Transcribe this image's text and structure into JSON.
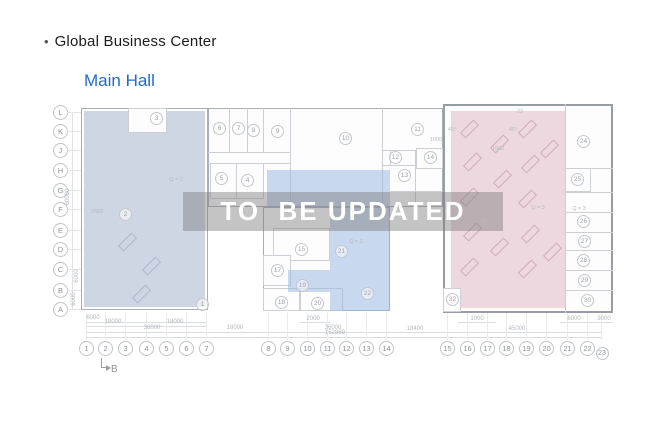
{
  "header": {
    "bullet": "•",
    "title": "Global Business Center",
    "subtitle": "Main Hall"
  },
  "watermark": {
    "text": "TO  BE UPDATED"
  },
  "colors": {
    "subtitle_accent": "#1c6dc9",
    "zone_left": "rgba(167,183,205,0.55)",
    "zone_middle": "rgba(148,180,226,0.5)",
    "zone_right": "rgba(214,164,182,0.42)",
    "watermark_bg": "rgba(125,125,125,0.45)",
    "watermark_text": "#ffffff"
  },
  "plan": {
    "row_axes": [
      {
        "label": "L",
        "y": 112
      },
      {
        "label": "K",
        "y": 131
      },
      {
        "label": "J",
        "y": 150
      },
      {
        "label": "H",
        "y": 170
      },
      {
        "label": "G",
        "y": 190
      },
      {
        "label": "F",
        "y": 209
      },
      {
        "label": "E",
        "y": 230
      },
      {
        "label": "D",
        "y": 249
      },
      {
        "label": "C",
        "y": 269
      },
      {
        "label": "B",
        "y": 290
      },
      {
        "label": "A",
        "y": 309
      }
    ],
    "col_axes": [
      {
        "label": "1",
        "x": 86
      },
      {
        "label": "2",
        "x": 105
      },
      {
        "label": "3",
        "x": 125
      },
      {
        "label": "4",
        "x": 146
      },
      {
        "label": "5",
        "x": 166
      },
      {
        "label": "6",
        "x": 186
      },
      {
        "label": "7",
        "x": 206
      },
      {
        "label": "8",
        "x": 268
      },
      {
        "label": "9",
        "x": 287
      },
      {
        "label": "10",
        "x": 307
      },
      {
        "label": "11",
        "x": 327
      },
      {
        "label": "12",
        "x": 346
      },
      {
        "label": "13",
        "x": 366
      },
      {
        "label": "14",
        "x": 386
      },
      {
        "label": "15",
        "x": 447
      },
      {
        "label": "16",
        "x": 467
      },
      {
        "label": "17",
        "x": 487
      },
      {
        "label": "18",
        "x": 506
      },
      {
        "label": "19",
        "x": 526
      },
      {
        "label": "20",
        "x": 546
      },
      {
        "label": "21",
        "x": 567
      },
      {
        "label": "22",
        "x": 587
      },
      {
        "label": "23",
        "x": 601,
        "small": true
      }
    ],
    "rooms": [
      {
        "n": "3",
        "x": 156,
        "y": 118
      },
      {
        "n": "6",
        "x": 219,
        "y": 128
      },
      {
        "n": "7",
        "x": 238,
        "y": 128
      },
      {
        "n": "8",
        "x": 253,
        "y": 130
      },
      {
        "n": "9",
        "x": 277,
        "y": 131
      },
      {
        "n": "10",
        "x": 345,
        "y": 138
      },
      {
        "n": "11",
        "x": 417,
        "y": 129
      },
      {
        "n": "12",
        "x": 395,
        "y": 157
      },
      {
        "n": "13",
        "x": 404,
        "y": 175
      },
      {
        "n": "14",
        "x": 430,
        "y": 157
      },
      {
        "n": "5",
        "x": 221,
        "y": 178
      },
      {
        "n": "4",
        "x": 247,
        "y": 180
      },
      {
        "n": "15",
        "x": 301,
        "y": 249
      },
      {
        "n": "17",
        "x": 277,
        "y": 270
      },
      {
        "n": "18",
        "x": 281,
        "y": 302
      },
      {
        "n": "19",
        "x": 302,
        "y": 285
      },
      {
        "n": "20",
        "x": 317,
        "y": 303
      },
      {
        "n": "21",
        "x": 341,
        "y": 251
      },
      {
        "n": "22",
        "x": 367,
        "y": 293
      },
      {
        "n": "24",
        "x": 583,
        "y": 141
      },
      {
        "n": "25",
        "x": 577,
        "y": 179
      },
      {
        "n": "26",
        "x": 583,
        "y": 221
      },
      {
        "n": "27",
        "x": 584,
        "y": 241
      },
      {
        "n": "28",
        "x": 583,
        "y": 260
      },
      {
        "n": "29",
        "x": 584,
        "y": 280
      },
      {
        "n": "30",
        "x": 587,
        "y": 300
      },
      {
        "n": "32",
        "x": 452,
        "y": 299
      },
      {
        "n": "2",
        "x": 125,
        "y": 214
      },
      {
        "n": "1",
        "x": 202,
        "y": 304
      }
    ],
    "dims_h": [
      {
        "t": "6000",
        "x": 93,
        "y": 319
      },
      {
        "t": "18000",
        "x": 113,
        "y": 323
      },
      {
        "t": "18000",
        "x": 175,
        "y": 323
      },
      {
        "t": "36000",
        "x": 152,
        "y": 329
      },
      {
        "t": "18000",
        "x": 235,
        "y": 329
      },
      {
        "t": "2000",
        "x": 313,
        "y": 320
      },
      {
        "t": "36000",
        "x": 333,
        "y": 329
      },
      {
        "t": "152869",
        "x": 335,
        "y": 334
      },
      {
        "t": "1000",
        "x": 477,
        "y": 320
      },
      {
        "t": "18400",
        "x": 415,
        "y": 330
      },
      {
        "t": "45000",
        "x": 517,
        "y": 330
      },
      {
        "t": "6000",
        "x": 574,
        "y": 320
      },
      {
        "t": "3000",
        "x": 604,
        "y": 320
      }
    ],
    "dims_v": [
      {
        "t": "60000",
        "x": 68,
        "y": 198
      },
      {
        "t": "6000",
        "x": 77,
        "y": 277
      },
      {
        "t": "6000",
        "x": 74,
        "y": 300
      }
    ],
    "notes": [
      {
        "t": "Q = 3",
        "x": 176,
        "y": 181
      },
      {
        "t": "Q = 3",
        "x": 356,
        "y": 243
      },
      {
        "t": "Q = 3",
        "x": 538,
        "y": 209
      },
      {
        "t": "Q = 3",
        "x": 579,
        "y": 210
      },
      {
        "t": "2693",
        "x": 97,
        "y": 213
      },
      {
        "t": "45°",
        "x": 452,
        "y": 131
      },
      {
        "t": "45°",
        "x": 513,
        "y": 131
      },
      {
        "t": "1000",
        "x": 436,
        "y": 141
      },
      {
        "t": "1900",
        "x": 498,
        "y": 150
      },
      {
        "t": "23",
        "x": 520,
        "y": 113
      },
      {
        "t": "31",
        "x": 484,
        "y": 223
      }
    ],
    "section_marker": {
      "label": "B"
    }
  }
}
